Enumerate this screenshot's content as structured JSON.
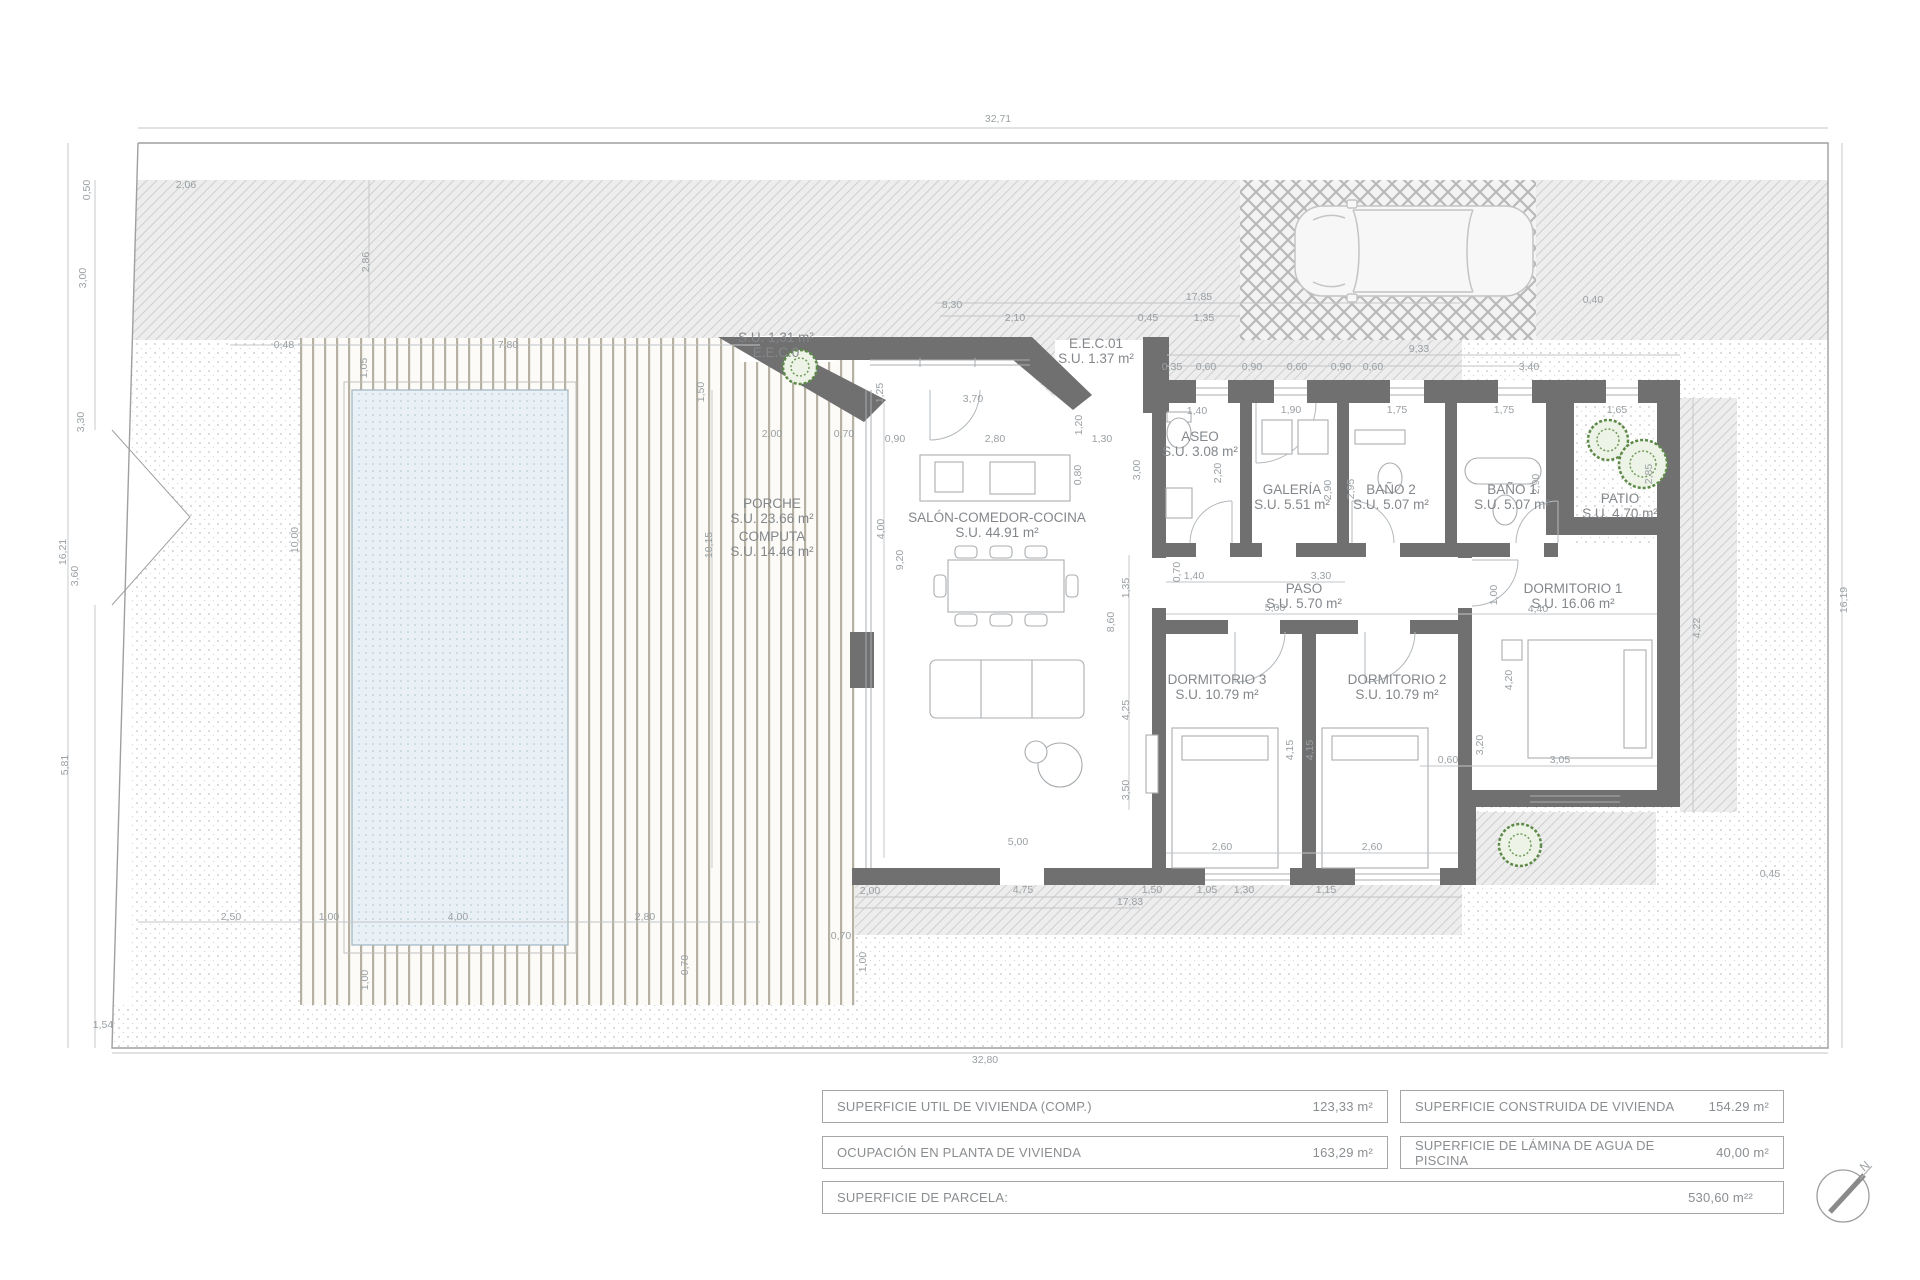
{
  "colors": {
    "wall": "#707070",
    "dim_text": "#9aa0a4",
    "room_text": "#83878b",
    "pool_fill": "#eaf1f6",
    "tree_green": "#5d8a48",
    "boundary_line": "#9f9f9f"
  },
  "compass": {
    "north_label": "N"
  },
  "summary_table": {
    "rows": [
      {
        "cells": [
          {
            "label": "SUPERFICIE UTIL  DE VIVIENDA (COMP.)",
            "value": "123,33  m²"
          },
          {
            "label": "SUPERFICIE CONSTRUIDA DE VIVIENDA",
            "value": "154.29  m²"
          }
        ]
      },
      {
        "cells": [
          {
            "label": "OCUPACIÓN EN PLANTA DE VIVIENDA",
            "value": "163,29 m²"
          },
          {
            "label": "SUPERFICIE DE LÁMINA DE AGUA DE PISCINA",
            "value": "40,00  m²"
          }
        ]
      },
      {
        "cells": [
          {
            "label": "SUPERFICIE DE PARCELA:",
            "value": "530,60 m²²"
          }
        ]
      }
    ]
  },
  "plan": {
    "rooms": [
      {
        "line1": "PORCHE",
        "line2": "S.U. 23.66 m²",
        "x": 772,
        "y": 508
      },
      {
        "line1": "COMPUTA",
        "line2": "S.U. 14.46 m²",
        "x": 772,
        "y": 541
      },
      {
        "line1": "SALÓN-COMEDOR-COCINA",
        "line2": "S.U. 44.91 m²",
        "x": 997,
        "y": 522
      },
      {
        "line1": "ASEO",
        "line2": "S.U. 3.08 m²",
        "x": 1200,
        "y": 441
      },
      {
        "line1": "GALERÍA",
        "line2": "S.U. 5.51 m²",
        "x": 1292,
        "y": 494
      },
      {
        "line1": "BAÑO 2",
        "line2": "S.U. 5.07 m²",
        "x": 1391,
        "y": 494
      },
      {
        "line1": "BAÑO 1",
        "line2": "S.U. 5.07 m²",
        "x": 1512,
        "y": 494
      },
      {
        "line1": "PATIO",
        "line2": "S.U. 4.70 m²",
        "x": 1620,
        "y": 503
      },
      {
        "line1": "PASO",
        "line2": "S.U. 5.70 m²",
        "x": 1304,
        "y": 593
      },
      {
        "line1": "DORMITORIO 1",
        "line2": "S.U. 16.06 m²",
        "x": 1573,
        "y": 593
      },
      {
        "line1": "DORMITORIO 3",
        "line2": "S.U. 10.79 m²",
        "x": 1217,
        "y": 684
      },
      {
        "line1": "DORMITORIO 2",
        "line2": "S.U. 10.79 m²",
        "x": 1397,
        "y": 684
      },
      {
        "line1": "S.U. 1,31 m²",
        "line2": "E.E.C.0",
        "x": 776,
        "y": 342
      },
      {
        "line1": "E.E.C.01",
        "line2": "S.U. 1.37 m²",
        "x": 1096,
        "y": 348
      }
    ],
    "dimensions": [
      {
        "t": "32,71",
        "x": 998,
        "y": 122
      },
      {
        "t": "32,80",
        "x": 985,
        "y": 1063
      },
      {
        "t": "16,21",
        "x": 66,
        "y": 552,
        "r": -90
      },
      {
        "t": "16,19",
        "x": 1847,
        "y": 600,
        "r": -90
      },
      {
        "t": "0,50",
        "x": 90,
        "y": 190,
        "r": -90
      },
      {
        "t": "3,00",
        "x": 86,
        "y": 278,
        "r": -90
      },
      {
        "t": "3,30",
        "x": 84,
        "y": 422,
        "r": -90
      },
      {
        "t": "3,60",
        "x": 78,
        "y": 576,
        "r": -90
      },
      {
        "t": "5,81",
        "x": 68,
        "y": 765,
        "r": -90
      },
      {
        "t": "1,54",
        "x": 103,
        "y": 1028
      },
      {
        "t": "2,06",
        "x": 186,
        "y": 188
      },
      {
        "t": "2,86",
        "x": 369,
        "y": 262,
        "r": -90
      },
      {
        "t": "8,30",
        "x": 952,
        "y": 308
      },
      {
        "t": "17,85",
        "x": 1199,
        "y": 300
      },
      {
        "t": "2,10",
        "x": 1015,
        "y": 321
      },
      {
        "t": "0,45",
        "x": 1148,
        "y": 321
      },
      {
        "t": "1,35",
        "x": 1204,
        "y": 321
      },
      {
        "t": "0,40",
        "x": 1593,
        "y": 303
      },
      {
        "t": "9,33",
        "x": 1419,
        "y": 352
      },
      {
        "t": "0,35",
        "x": 1172,
        "y": 370
      },
      {
        "t": "0,60",
        "x": 1206,
        "y": 370
      },
      {
        "t": "0,90",
        "x": 1252,
        "y": 370
      },
      {
        "t": "0,60",
        "x": 1297,
        "y": 370
      },
      {
        "t": "0,90",
        "x": 1341,
        "y": 370
      },
      {
        "t": "0,60",
        "x": 1373,
        "y": 370
      },
      {
        "t": "3,40",
        "x": 1529,
        "y": 370
      },
      {
        "t": "0,48",
        "x": 284,
        "y": 348
      },
      {
        "t": "7,80",
        "x": 508,
        "y": 348
      },
      {
        "t": "1,05",
        "x": 367,
        "y": 368,
        "r": -90
      },
      {
        "t": "1,50",
        "x": 704,
        "y": 392,
        "r": -90
      },
      {
        "t": "3,70",
        "x": 973,
        "y": 402
      },
      {
        "t": "1,25",
        "x": 883,
        "y": 393,
        "r": -90
      },
      {
        "t": "1,20",
        "x": 1082,
        "y": 425,
        "r": -90
      },
      {
        "t": "2,80",
        "x": 995,
        "y": 442
      },
      {
        "t": "0,90",
        "x": 895,
        "y": 442
      },
      {
        "t": "1,30",
        "x": 1102,
        "y": 442
      },
      {
        "t": "2,00",
        "x": 772,
        "y": 437
      },
      {
        "t": "0,70",
        "x": 844,
        "y": 437
      },
      {
        "t": "0,80",
        "x": 1081,
        "y": 475,
        "r": -90
      },
      {
        "t": "3,00",
        "x": 1140,
        "y": 470,
        "r": -90
      },
      {
        "t": "1,40",
        "x": 1197,
        "y": 414
      },
      {
        "t": "2,20",
        "x": 1221,
        "y": 473,
        "r": -90
      },
      {
        "t": "1,90",
        "x": 1291,
        "y": 413
      },
      {
        "t": "2,90",
        "x": 1331,
        "y": 490,
        "r": -90
      },
      {
        "t": "1,75",
        "x": 1397,
        "y": 413
      },
      {
        "t": "1,75",
        "x": 1504,
        "y": 413
      },
      {
        "t": "2,95",
        "x": 1354,
        "y": 489,
        "r": -90
      },
      {
        "t": "2,90",
        "x": 1539,
        "y": 484,
        "r": -90
      },
      {
        "t": "1,65",
        "x": 1617,
        "y": 413
      },
      {
        "t": "2,85",
        "x": 1652,
        "y": 474,
        "r": -90
      },
      {
        "t": "4,00",
        "x": 884,
        "y": 529,
        "r": -90
      },
      {
        "t": "9,20",
        "x": 903,
        "y": 560,
        "r": -90
      },
      {
        "t": "10,15",
        "x": 712,
        "y": 545,
        "r": -90
      },
      {
        "t": "10,00",
        "x": 298,
        "y": 540,
        "r": -90
      },
      {
        "t": "1,40",
        "x": 1194,
        "y": 579
      },
      {
        "t": "3,30",
        "x": 1321,
        "y": 579
      },
      {
        "t": "0,70",
        "x": 1180,
        "y": 572,
        "r": -90
      },
      {
        "t": "5,00",
        "x": 1275,
        "y": 611
      },
      {
        "t": "8,60",
        "x": 1114,
        "y": 622,
        "r": -90
      },
      {
        "t": "1,35",
        "x": 1129,
        "y": 588,
        "r": -90
      },
      {
        "t": "1,00",
        "x": 1497,
        "y": 595,
        "r": -90
      },
      {
        "t": "4,40",
        "x": 1538,
        "y": 612
      },
      {
        "t": "4,25",
        "x": 1129,
        "y": 710,
        "r": -90
      },
      {
        "t": "3,50",
        "x": 1129,
        "y": 790,
        "r": -90
      },
      {
        "t": "5,00",
        "x": 1018,
        "y": 845
      },
      {
        "t": "4,15",
        "x": 1293,
        "y": 750,
        "r": -90
      },
      {
        "t": "4,15",
        "x": 1313,
        "y": 750,
        "r": -90
      },
      {
        "t": "3,20",
        "x": 1483,
        "y": 745,
        "r": -90
      },
      {
        "t": "4,20",
        "x": 1512,
        "y": 680,
        "r": -90
      },
      {
        "t": "0,60",
        "x": 1448,
        "y": 763
      },
      {
        "t": "3,05",
        "x": 1560,
        "y": 763
      },
      {
        "t": "2,60",
        "x": 1222,
        "y": 850
      },
      {
        "t": "2,60",
        "x": 1372,
        "y": 850
      },
      {
        "t": "2,00",
        "x": 870,
        "y": 894
      },
      {
        "t": "4,75",
        "x": 1023,
        "y": 893
      },
      {
        "t": "17,83",
        "x": 1130,
        "y": 905
      },
      {
        "t": "1,50",
        "x": 1152,
        "y": 893
      },
      {
        "t": "1,05",
        "x": 1207,
        "y": 893
      },
      {
        "t": "1,30",
        "x": 1244,
        "y": 893
      },
      {
        "t": "1,15",
        "x": 1326,
        "y": 893
      },
      {
        "t": "0,70",
        "x": 841,
        "y": 939
      },
      {
        "t": "1,00",
        "x": 866,
        "y": 962,
        "r": -90
      },
      {
        "t": "2,50",
        "x": 231,
        "y": 920
      },
      {
        "t": "1,00",
        "x": 329,
        "y": 920
      },
      {
        "t": "4,00",
        "x": 458,
        "y": 920
      },
      {
        "t": "2,80",
        "x": 645,
        "y": 920
      },
      {
        "t": "1,00",
        "x": 368,
        "y": 980,
        "r": -90
      },
      {
        "t": "0,70",
        "x": 688,
        "y": 965,
        "r": -90
      },
      {
        "t": "4,22",
        "x": 1700,
        "y": 628,
        "r": -90
      },
      {
        "t": "0,45",
        "x": 1770,
        "y": 877
      }
    ]
  }
}
